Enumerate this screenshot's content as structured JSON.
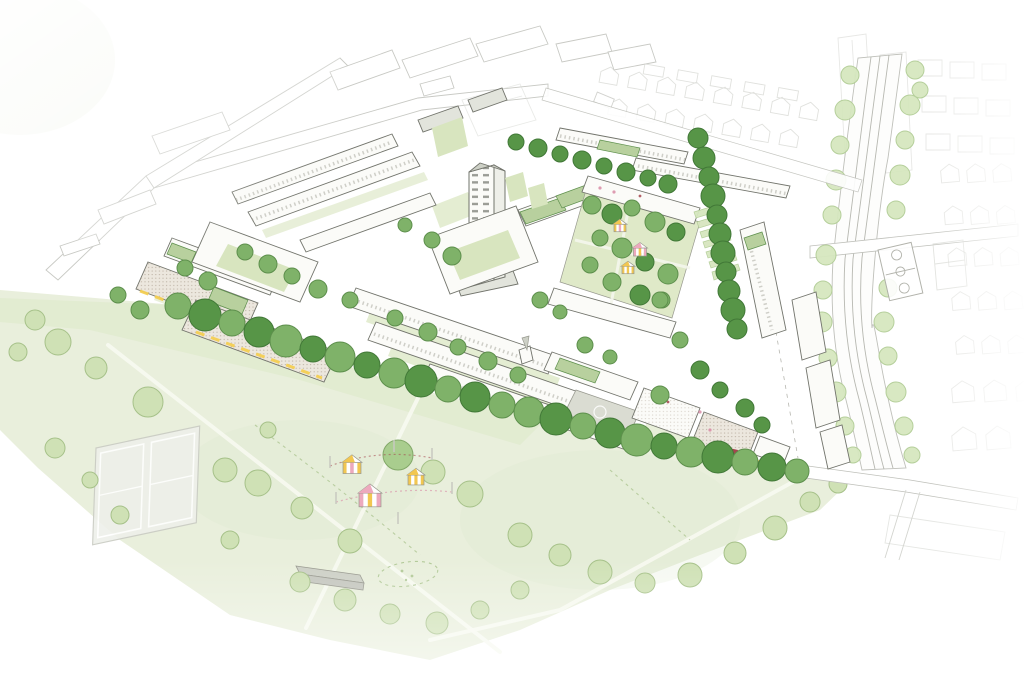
{
  "scene": {
    "subject": "Aerial axonometric masterplan illustration of a neighbourhood regeneration site beside a large public park and railway corridor",
    "style": "hand-drawn watercolour sketch, white background fading at edges",
    "text_content": "none"
  },
  "features": [
    {
      "name": "public-park",
      "note": "large pale-green park lower left with paths, tennis courts, event tents and pavilion"
    },
    {
      "name": "tennis-courts",
      "note": "two pale courts with white line markings in the park"
    },
    {
      "name": "event-tents",
      "note": "three striped marquee tents linked by bunting on poles"
    },
    {
      "name": "park-pavilion",
      "note": "small grey flat-roof building near park bottom"
    },
    {
      "name": "tree-lined-avenue",
      "note": "row of large green trees along the park edge of the site"
    },
    {
      "name": "central-tower",
      "note": "tall white residential tower with gridded windows"
    },
    {
      "name": "community-green",
      "note": "central garden square with trees and three small striped tents"
    },
    {
      "name": "allotments",
      "note": "strips of garden plots east of the community green"
    },
    {
      "name": "green-link",
      "note": "north-south tree-lined pedestrian route"
    },
    {
      "name": "mid-rise-blocks",
      "note": "perimeter housing blocks, some with green roofs and yellow shopfront bands"
    },
    {
      "name": "terraced-housing",
      "note": "rows of terraced houses across the south of the site"
    },
    {
      "name": "school-yard",
      "note": "grey paved playground with games circle"
    },
    {
      "name": "gateway-accent",
      "note": "small dark-red structures near the south-east corner"
    },
    {
      "name": "railway-corridor",
      "note": "curving multi-track railway flanked by light green tree belts"
    },
    {
      "name": "basketball-court",
      "note": "small court beside the railway"
    },
    {
      "name": "context-housing",
      "note": "faint outline streets and terraces surrounding the site"
    }
  ],
  "palette": {
    "ink": "#72746c",
    "ink_soft": "#98998f",
    "context_line": "#bfc0ba",
    "context_line2": "#d4d5d0",
    "building_wall": "#fbfbf8",
    "building_roof": "#e2e4dc",
    "roof_dark": "#cdd0c6",
    "brick_base": "#ece7de",
    "green_roof": "#b8d09e",
    "park_wash": "#e9efdc",
    "park_wash2": "#dde9ca",
    "grass_mid": "#d8e5bf",
    "tree_dark": "#579547",
    "tree_dark_line": "#417837",
    "tree_mid": "#7fb269",
    "tree_mid_line": "#5d8f4c",
    "tree_light": "#a9cd8e",
    "tree_light_line": "#82a868",
    "tree_pale": "#cfe1b5",
    "tree_pale_line": "#a6c189",
    "belt": "#d6e7bf",
    "belt_line": "#b2cd96",
    "yellow": "#f4cf52",
    "red": "#a4454e",
    "pink_dot": "#d98ca6",
    "tent_yellow": "#f2c751",
    "tent_pink": "#eda9bd",
    "court": "#eef0ea",
    "court_edge": "#c9cbc3",
    "playground": "#dadcd2",
    "path": "#f7f9ef",
    "rail": "#aaaba3"
  },
  "trees": {
    "south_avenue": [
      [
        178,
        306,
        13,
        "tree_mid"
      ],
      [
        205,
        315,
        16,
        "tree_dark"
      ],
      [
        232,
        323,
        13,
        "tree_mid"
      ],
      [
        259,
        332,
        15,
        "tree_dark"
      ],
      [
        286,
        341,
        16,
        "tree_mid"
      ],
      [
        313,
        349,
        13,
        "tree_dark"
      ],
      [
        340,
        357,
        15,
        "tree_mid"
      ],
      [
        367,
        365,
        13,
        "tree_dark"
      ],
      [
        394,
        373,
        15,
        "tree_mid"
      ],
      [
        421,
        381,
        16,
        "tree_dark"
      ],
      [
        448,
        389,
        13,
        "tree_mid"
      ],
      [
        475,
        397,
        15,
        "tree_dark"
      ],
      [
        502,
        405,
        13,
        "tree_mid"
      ],
      [
        529,
        412,
        15,
        "tree_mid"
      ],
      [
        556,
        419,
        16,
        "tree_dark"
      ],
      [
        583,
        426,
        13,
        "tree_mid"
      ],
      [
        610,
        433,
        15,
        "tree_dark"
      ],
      [
        637,
        440,
        16,
        "tree_mid"
      ],
      [
        664,
        446,
        13,
        "tree_dark"
      ],
      [
        691,
        452,
        15,
        "tree_mid"
      ],
      [
        718,
        457,
        16,
        "tree_dark"
      ],
      [
        745,
        462,
        13,
        "tree_mid"
      ],
      [
        772,
        467,
        14,
        "tree_dark"
      ],
      [
        797,
        471,
        12,
        "tree_mid"
      ]
    ],
    "park": [
      [
        58,
        342,
        13,
        "tree_pale"
      ],
      [
        96,
        368,
        11,
        "tree_pale"
      ],
      [
        148,
        402,
        15,
        "tree_pale"
      ],
      [
        55,
        448,
        10,
        "tree_pale"
      ],
      [
        225,
        470,
        12,
        "tree_pale"
      ],
      [
        258,
        483,
        13,
        "tree_pale"
      ],
      [
        302,
        508,
        11,
        "tree_pale"
      ],
      [
        350,
        541,
        12,
        "tree_pale"
      ],
      [
        398,
        455,
        15,
        "tree_light"
      ],
      [
        433,
        472,
        12,
        "tree_pale"
      ],
      [
        470,
        494,
        13,
        "tree_pale"
      ],
      [
        300,
        582,
        10,
        "tree_pale"
      ],
      [
        345,
        600,
        11,
        "tree_pale"
      ],
      [
        390,
        614,
        10,
        "tree_pale"
      ],
      [
        437,
        623,
        11,
        "tree_pale"
      ],
      [
        480,
        610,
        9,
        "tree_pale"
      ],
      [
        35,
        320,
        10,
        "tree_pale"
      ],
      [
        18,
        352,
        9,
        "tree_pale"
      ],
      [
        230,
        540,
        9,
        "tree_pale"
      ],
      [
        268,
        430,
        8,
        "tree_pale"
      ],
      [
        520,
        590,
        9,
        "tree_pale"
      ],
      [
        120,
        515,
        9,
        "tree_pale"
      ],
      [
        90,
        480,
        8,
        "tree_pale"
      ],
      [
        520,
        535,
        12,
        "tree_pale"
      ],
      [
        560,
        555,
        11,
        "tree_pale"
      ],
      [
        600,
        572,
        12,
        "tree_pale"
      ],
      [
        645,
        583,
        10,
        "tree_pale"
      ],
      [
        690,
        575,
        12,
        "tree_pale"
      ],
      [
        735,
        553,
        11,
        "tree_pale"
      ],
      [
        775,
        528,
        12,
        "tree_pale"
      ],
      [
        810,
        502,
        10,
        "tree_pale"
      ],
      [
        838,
        484,
        9,
        "tree_pale"
      ]
    ],
    "green_link": [
      [
        698,
        138,
        10,
        "tree_dark"
      ],
      [
        704,
        158,
        11,
        "tree_dark"
      ],
      [
        709,
        177,
        10,
        "tree_dark"
      ],
      [
        713,
        196,
        12,
        "tree_dark"
      ],
      [
        717,
        215,
        10,
        "tree_dark"
      ],
      [
        720,
        234,
        11,
        "tree_dark"
      ],
      [
        723,
        253,
        12,
        "tree_dark"
      ],
      [
        726,
        272,
        10,
        "tree_dark"
      ],
      [
        729,
        291,
        11,
        "tree_dark"
      ],
      [
        733,
        310,
        12,
        "tree_dark"
      ],
      [
        737,
        329,
        10,
        "tree_dark"
      ]
    ],
    "north_street": [
      [
        516,
        142,
        8,
        "tree_dark"
      ],
      [
        538,
        148,
        9,
        "tree_dark"
      ],
      [
        560,
        154,
        8,
        "tree_dark"
      ],
      [
        582,
        160,
        9,
        "tree_dark"
      ],
      [
        604,
        166,
        8,
        "tree_dark"
      ],
      [
        626,
        172,
        9,
        "tree_dark"
      ],
      [
        648,
        178,
        8,
        "tree_dark"
      ],
      [
        668,
        184,
        9,
        "tree_dark"
      ]
    ],
    "site_scatter": [
      [
        185,
        268,
        8,
        "tree_mid"
      ],
      [
        208,
        281,
        9,
        "tree_mid"
      ],
      [
        245,
        252,
        8,
        "tree_mid"
      ],
      [
        268,
        264,
        9,
        "tree_mid"
      ],
      [
        292,
        276,
        8,
        "tree_mid"
      ],
      [
        318,
        289,
        9,
        "tree_mid"
      ],
      [
        350,
        300,
        8,
        "tree_mid"
      ],
      [
        395,
        318,
        8,
        "tree_mid"
      ],
      [
        428,
        332,
        9,
        "tree_mid"
      ],
      [
        458,
        347,
        8,
        "tree_mid"
      ],
      [
        488,
        361,
        9,
        "tree_mid"
      ],
      [
        518,
        375,
        8,
        "tree_mid"
      ],
      [
        432,
        240,
        8,
        "tree_mid"
      ],
      [
        452,
        256,
        9,
        "tree_mid"
      ],
      [
        405,
        225,
        7,
        "tree_mid"
      ],
      [
        540,
        300,
        8,
        "tree_mid"
      ],
      [
        560,
        312,
        7,
        "tree_mid"
      ],
      [
        585,
        345,
        8,
        "tree_mid"
      ],
      [
        610,
        357,
        7,
        "tree_mid"
      ],
      [
        660,
        300,
        8,
        "tree_mid"
      ],
      [
        680,
        340,
        8,
        "tree_mid"
      ],
      [
        700,
        370,
        9,
        "tree_dark"
      ],
      [
        720,
        390,
        8,
        "tree_dark"
      ],
      [
        745,
        408,
        9,
        "tree_dark"
      ],
      [
        762,
        425,
        8,
        "tree_dark"
      ],
      [
        660,
        395,
        9,
        "tree_mid"
      ],
      [
        140,
        310,
        9,
        "tree_mid"
      ],
      [
        118,
        295,
        8,
        "tree_mid"
      ]
    ],
    "garden_square": [
      [
        592,
        205,
        9,
        "tree_mid"
      ],
      [
        612,
        214,
        10,
        "tree_dark"
      ],
      [
        632,
        208,
        8,
        "tree_mid"
      ],
      [
        655,
        222,
        10,
        "tree_mid"
      ],
      [
        676,
        232,
        9,
        "tree_dark"
      ],
      [
        600,
        238,
        8,
        "tree_mid"
      ],
      [
        622,
        248,
        10,
        "tree_mid"
      ],
      [
        645,
        262,
        9,
        "tree_dark"
      ],
      [
        668,
        274,
        10,
        "tree_mid"
      ],
      [
        590,
        265,
        8,
        "tree_mid"
      ],
      [
        612,
        282,
        9,
        "tree_mid"
      ],
      [
        640,
        295,
        10,
        "tree_dark"
      ],
      [
        662,
        300,
        8,
        "tree_mid"
      ]
    ],
    "rail_belt_left": [
      [
        850,
        75,
        9,
        "belt"
      ],
      [
        845,
        110,
        10,
        "belt"
      ],
      [
        840,
        145,
        9,
        "belt"
      ],
      [
        836,
        180,
        10,
        "belt"
      ],
      [
        832,
        215,
        9,
        "belt"
      ],
      [
        826,
        255,
        10,
        "belt"
      ],
      [
        823,
        290,
        9,
        "belt"
      ],
      [
        822,
        322,
        10,
        "belt"
      ],
      [
        828,
        358,
        9,
        "belt"
      ],
      [
        836,
        392,
        10,
        "belt"
      ],
      [
        845,
        426,
        9,
        "belt"
      ],
      [
        853,
        455,
        8,
        "belt"
      ]
    ],
    "rail_belt_right": [
      [
        915,
        70,
        9,
        "belt"
      ],
      [
        910,
        105,
        10,
        "belt"
      ],
      [
        905,
        140,
        9,
        "belt"
      ],
      [
        900,
        175,
        10,
        "belt"
      ],
      [
        896,
        210,
        9,
        "belt"
      ],
      [
        888,
        288,
        9,
        "belt"
      ],
      [
        884,
        322,
        10,
        "belt"
      ],
      [
        888,
        356,
        9,
        "belt"
      ],
      [
        896,
        392,
        10,
        "belt"
      ],
      [
        904,
        426,
        9,
        "belt"
      ],
      [
        912,
        455,
        8,
        "belt"
      ],
      [
        920,
        90,
        8,
        "belt"
      ]
    ]
  },
  "tents": {
    "park_event": [
      [
        352,
        468,
        18,
        "tent_yellow",
        "tent_pink"
      ],
      [
        370,
        500,
        22,
        "tent_pink",
        "tent_yellow"
      ],
      [
        416,
        480,
        16,
        "tent_yellow",
        "tent_yellow"
      ]
    ],
    "garden": [
      [
        620,
        228,
        12,
        "tent_yellow",
        "tent_pink"
      ],
      [
        640,
        252,
        13,
        "tent_pink",
        "tent_yellow"
      ],
      [
        628,
        270,
        12,
        "tent_yellow",
        "tent_yellow"
      ]
    ]
  }
}
